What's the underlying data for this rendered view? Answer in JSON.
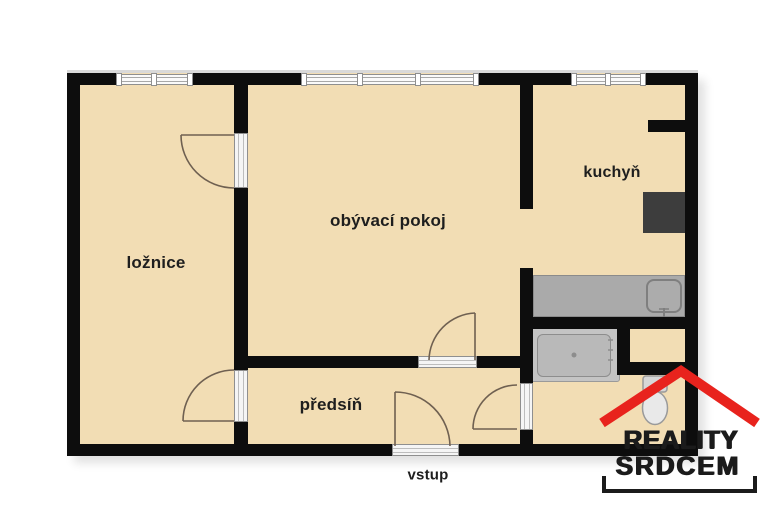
{
  "title": "apartment floor plan",
  "rooms": {
    "bedroom": "ložnice",
    "living_room": "obývací pokoj",
    "kitchen": "kuchyň",
    "hallway": "předsíň"
  },
  "entrance_label": "vstup",
  "logo": {
    "line1": "REALITY",
    "line2": "SRDCEM"
  },
  "colors": {
    "floor": "#f2ddb4",
    "wall": "#0d0d0d",
    "logo_red": "#e8231d",
    "logo_text": "#1b1b1b",
    "counter_gray": "#aaaaaa",
    "appliance_dark": "#3d3d3d"
  },
  "icons": {
    "windows": "window-icon",
    "doors": "door-swing-icon",
    "bathtub": "bathtub-icon",
    "toilet": "toilet-icon",
    "sink": "sink-icon",
    "stove": "stove-icon",
    "roof": "logo-roof-icon"
  }
}
